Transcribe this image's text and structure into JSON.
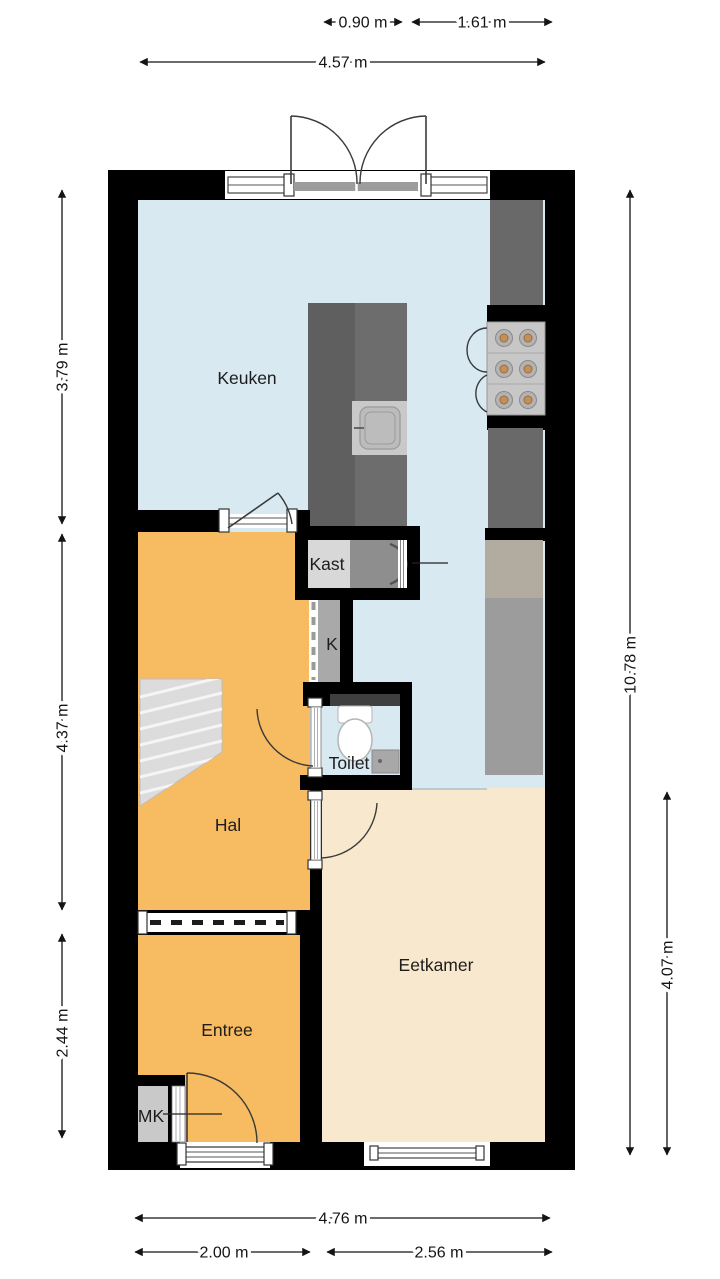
{
  "rooms": {
    "keuken": {
      "label": "Keuken"
    },
    "kast": {
      "label": "Kast"
    },
    "k": {
      "label": "K"
    },
    "toilet": {
      "label": "Toilet"
    },
    "hal": {
      "label": "Hal"
    },
    "entree": {
      "label": "Entree"
    },
    "mk": {
      "label": "MK"
    },
    "eetkamer": {
      "label": "Eetkamer"
    }
  },
  "dimensions": {
    "top": [
      {
        "label": "0.90 m"
      },
      {
        "label": "1.61 m"
      },
      {
        "label": "4.57 m"
      }
    ],
    "left": [
      {
        "label": "3.79 m"
      },
      {
        "label": "4.37 m"
      },
      {
        "label": "2.44 m"
      }
    ],
    "right": [
      {
        "label": "10.78 m"
      },
      {
        "label": "4.07 m"
      }
    ],
    "bottom": [
      {
        "label": "4.76 m"
      },
      {
        "label": "2.00 m"
      },
      {
        "label": "2.56 m"
      }
    ]
  },
  "colors": {
    "wall": "#000000",
    "floor_keuken": "#d8e9f1",
    "floor_hal": "#f7bc62",
    "floor_entree": "#f7bc62",
    "floor_eetkamer": "#f8e8cd",
    "island": "#6d6d6d",
    "island_dark": "#5f5f5f",
    "counter": "#696969",
    "cabinet_tall": "#9c9c9c",
    "fridge": "#b2aba0",
    "stove": "#c7c7c7",
    "burner_center": "#c4905a",
    "kast_closet": "#d8d8d8",
    "washer": "#8e8e8e",
    "k_shaft": "#a9a9a9",
    "mk_closet": "#c9c9c9",
    "stairs": "#dcdcdc",
    "toilet_cistern_band": "#3f3f3f",
    "dim_text": "#141414"
  }
}
